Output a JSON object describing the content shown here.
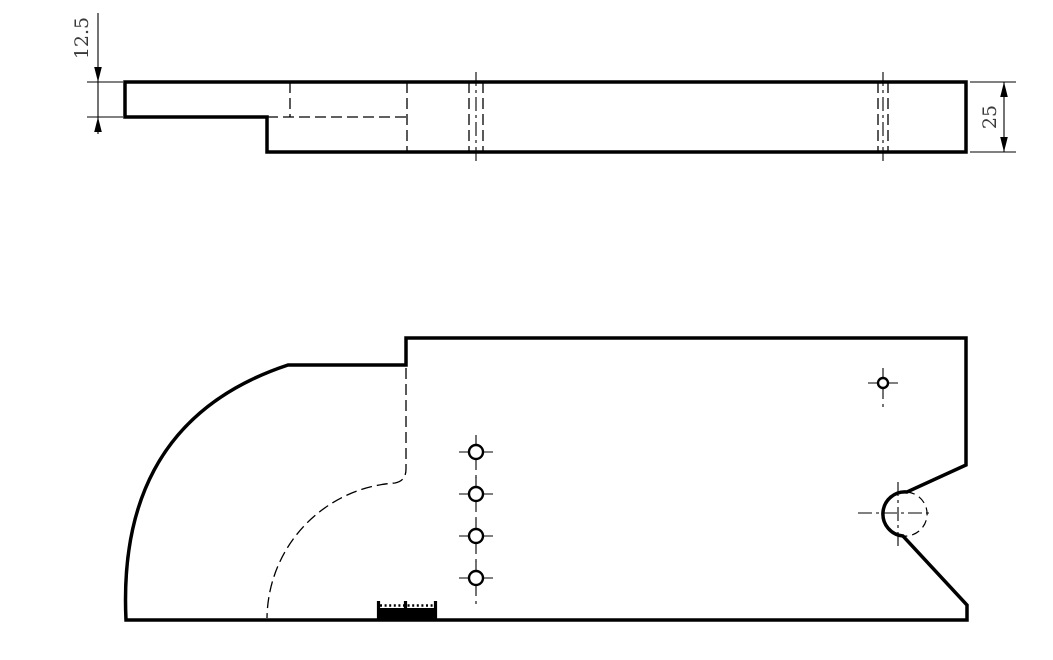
{
  "colors": {
    "line": "#000000",
    "dimension_text": "#3a3a3a",
    "background": "#ffffff"
  },
  "side_view": {
    "dim_thickness_label": "12.5",
    "dim_height_label": "25"
  },
  "plan_view": {
    "small_hole_radius": 7,
    "small_hole_cross": 17,
    "small_holes": [
      {
        "cx": 476,
        "cy": 452
      },
      {
        "cx": 476,
        "cy": 494
      },
      {
        "cx": 476,
        "cy": 536
      },
      {
        "cx": 476,
        "cy": 578
      }
    ],
    "corner_hole": {
      "cx": 883,
      "cy": 383,
      "r": 5,
      "cross": 15
    },
    "notch_circle": {
      "cx": 898,
      "cy": 513,
      "r": 17
    }
  }
}
